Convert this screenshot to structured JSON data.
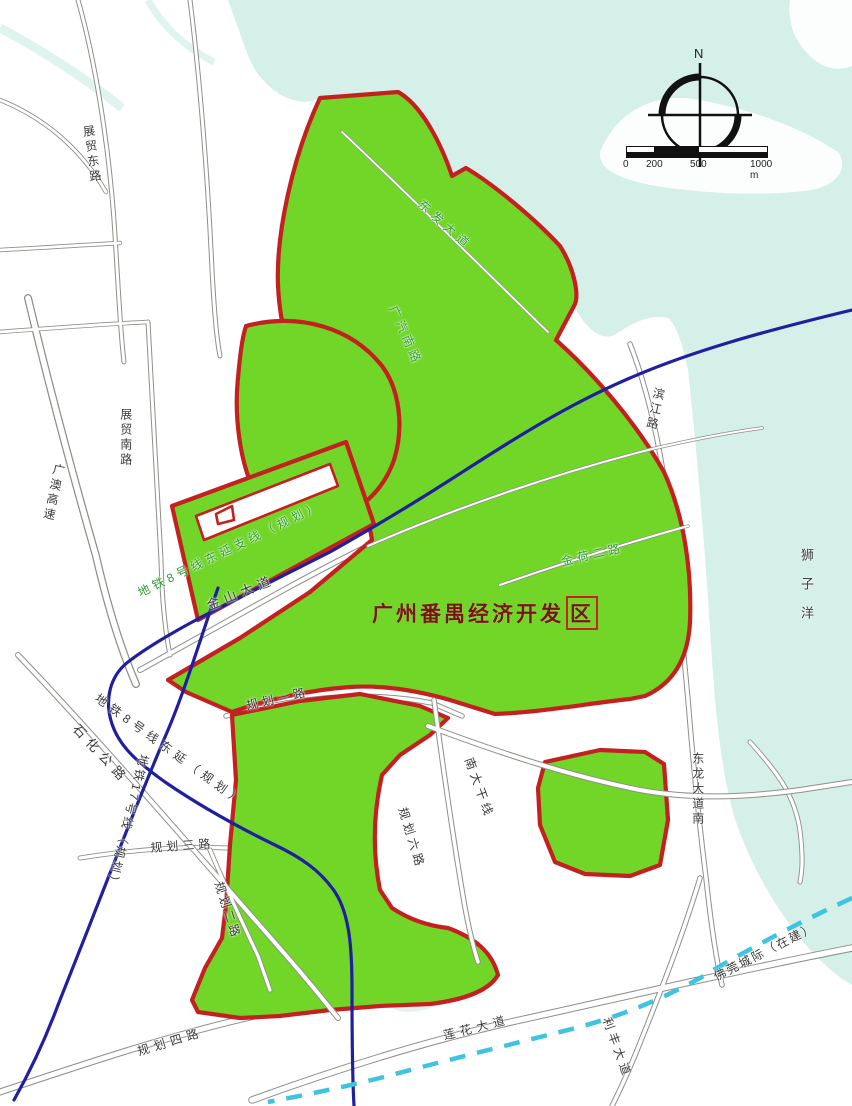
{
  "map": {
    "title_prefix": "广州番禺经济开发",
    "title_boxed": "区",
    "compass_n": "N",
    "scalebar": {
      "t0": "0",
      "t200": "200",
      "t500": "500",
      "t1000": "1000 m"
    },
    "labels": {
      "zhanmao_east_rd": "展贸东路",
      "zhanmao_south_rd": "展贸南路",
      "guangao_expwy": "广澳高速",
      "shihua_hwy": "石化公路",
      "jinshan_ave": "金山大道",
      "metro8_branch": "地铁8号线东延支线（规划）",
      "metro8_ext": "地铁8号线东延（规划）",
      "metro17": "地铁17号线（规划）",
      "guihua1_rd": "规划一路",
      "guihua2_rd": "规划二路",
      "guihua3_rd": "规划三路",
      "guihua4_rd": "规划四路",
      "guihua6_rd": "规划六路",
      "nanda_trunk": "南大干线",
      "lianhua_ave": "莲花大道",
      "lifeng_ave": "利丰大道",
      "foguan_intercity": "佛莞城际（在建）",
      "donglong_ave_south": "东龙大道南",
      "binjiang_rd": "滨江路",
      "shiziyang": "狮子洋",
      "dongfa_ave": "东发大道",
      "guangqi_south_rd": "广汽南路",
      "jinhe2_rd": "金荷二路"
    },
    "colors": {
      "zone_fill": "#72d629",
      "zone_border": "#c42020",
      "water": "#d5efe9",
      "metro_blue": "#1f1fa0",
      "intercity_cyan": "#3ec3e0",
      "title_red": "#7a1414"
    }
  }
}
